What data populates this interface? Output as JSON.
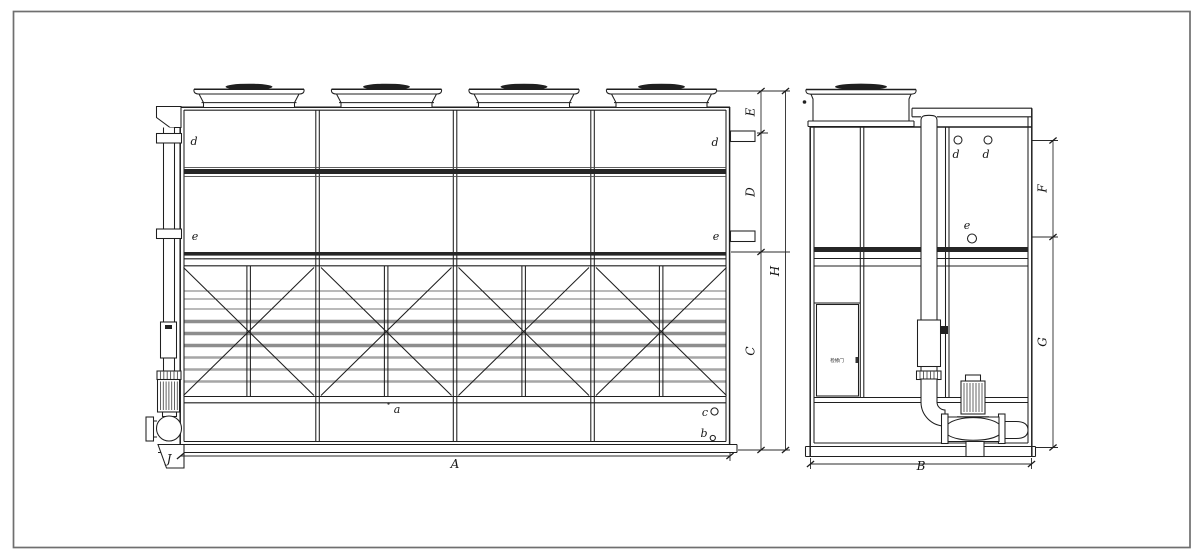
{
  "sheet": {
    "type": "technical-drawing",
    "description": "Closed-circuit cooling tower general arrangement, front view and side view",
    "background": "#ffffff",
    "line_color": "#1f1f1f",
    "border_color": "#6f6f6f"
  },
  "front_view": {
    "dim_labels": {
      "A": "A",
      "C": "C",
      "D": "D",
      "E": "E",
      "H": "H",
      "J": "J"
    },
    "part_labels": {
      "a": "a",
      "b": "b",
      "c": "c",
      "d_left": "d",
      "d_right": "d",
      "e_left": "e",
      "e_right": "e"
    }
  },
  "side_view": {
    "dim_labels": {
      "B": "B",
      "F": "F",
      "G": "G"
    },
    "part_labels": {
      "d_1": "d",
      "d_2": "d",
      "e": "e"
    },
    "door_label": "检修门"
  }
}
